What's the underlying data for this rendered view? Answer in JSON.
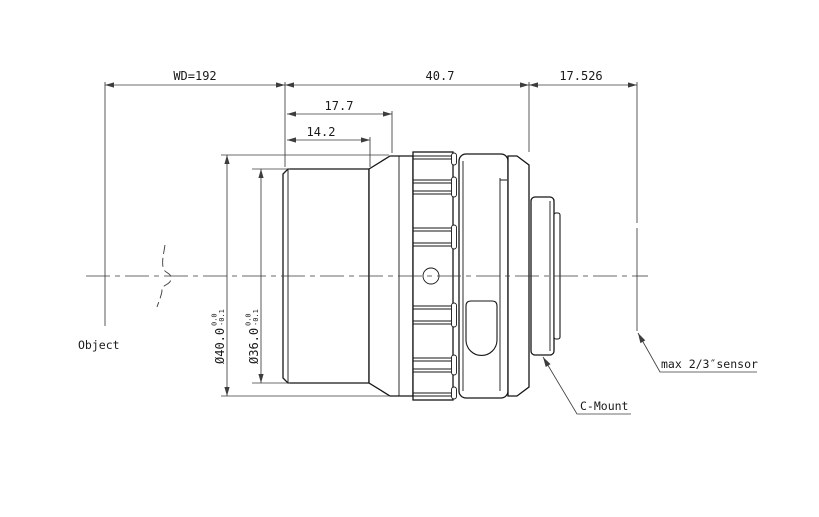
{
  "labels": {
    "object": "Object",
    "c_mount": "C-Mount",
    "sensor": "max 2/3″sensor"
  },
  "dimensions": {
    "working_distance": "WD=192",
    "body_length": "40.7",
    "flange_focal_distance": "17.526",
    "front_section_length": "17.7",
    "front_barrel_length": "14.2",
    "max_diameter": "Ø40.0",
    "max_diameter_tol_upper": "0.0",
    "max_diameter_tol_lower": "-0.1",
    "front_diameter": "Ø36.0",
    "front_diameter_tol_upper": "0.0",
    "front_diameter_tol_lower": "-0.1"
  },
  "colors": {
    "outline": "#161616",
    "dimension": "#3d3d3d",
    "background": "#ffffff"
  }
}
